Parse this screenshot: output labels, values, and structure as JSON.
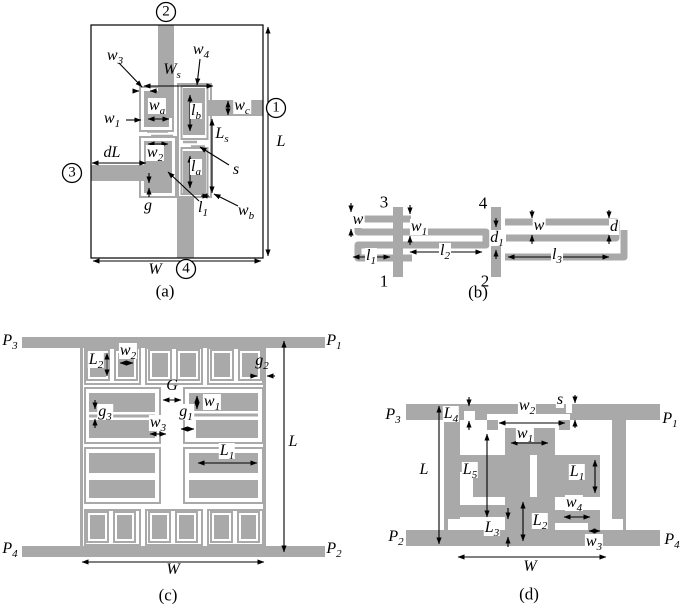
{
  "colors": {
    "metal": "#a9a9a9",
    "line": "#000000",
    "background": "#ffffff"
  },
  "figures": {
    "a": {
      "caption": "(a)",
      "ports": {
        "p1": "1",
        "p2": "2",
        "p3": "3",
        "p4": "4"
      },
      "labels": {
        "w3": {
          "b": "w",
          "s": "3"
        },
        "w4": {
          "b": "w",
          "s": "4"
        },
        "Ws": {
          "b": "W",
          "s": "s"
        },
        "wc": {
          "b": "w",
          "s": "c"
        },
        "wa": {
          "b": "w",
          "s": "a"
        },
        "w1": {
          "b": "w",
          "s": "1"
        },
        "lb": {
          "b": "l",
          "s": "b"
        },
        "Ls": {
          "b": "L",
          "s": "s"
        },
        "dL": {
          "b": "dL"
        },
        "w2": {
          "b": "w",
          "s": "2"
        },
        "s": {
          "b": "s"
        },
        "la": {
          "b": "l",
          "s": "a"
        },
        "g": {
          "b": "g"
        },
        "l1": {
          "b": "l",
          "s": "1"
        },
        "wb": {
          "b": "w",
          "s": "b"
        },
        "L": {
          "b": "L"
        },
        "W": {
          "b": "W"
        }
      }
    },
    "b": {
      "caption": "(b)",
      "ports": {
        "n1": "1",
        "n2": "2",
        "n3": "3",
        "n4": "4"
      },
      "labels": {
        "w_left": {
          "b": "w"
        },
        "w1": {
          "b": "w",
          "s": "1"
        },
        "l1": {
          "b": "l",
          "s": "1"
        },
        "l2": {
          "b": "l",
          "s": "2"
        },
        "l3": {
          "b": "l",
          "s": "3"
        },
        "d1": {
          "b": "d",
          "s": "1"
        },
        "w_right": {
          "b": "w"
        },
        "d": {
          "b": "d"
        }
      }
    },
    "c": {
      "caption": "(c)",
      "ports": {
        "P1": {
          "b": "P",
          "s": "1"
        },
        "P2": {
          "b": "P",
          "s": "2"
        },
        "P3": {
          "b": "P",
          "s": "3"
        },
        "P4": {
          "b": "P",
          "s": "4"
        }
      },
      "labels": {
        "L2": {
          "b": "L",
          "s": "2"
        },
        "w2": {
          "b": "w",
          "s": "2"
        },
        "g2": {
          "b": "g",
          "s": "2"
        },
        "G": {
          "b": "G"
        },
        "g3": {
          "b": "g",
          "s": "3"
        },
        "w1": {
          "b": "w",
          "s": "1"
        },
        "g1": {
          "b": "g",
          "s": "1"
        },
        "w3": {
          "b": "w",
          "s": "3"
        },
        "L1": {
          "b": "L",
          "s": "1"
        },
        "L": {
          "b": "L"
        },
        "W": {
          "b": "W"
        }
      }
    },
    "d": {
      "caption": "(d)",
      "ports": {
        "P1": {
          "b": "P",
          "s": "1"
        },
        "P2": {
          "b": "P",
          "s": "2"
        },
        "P3": {
          "b": "P",
          "s": "3"
        },
        "P4": {
          "b": "P",
          "s": "4"
        }
      },
      "labels": {
        "L4": {
          "b": "L",
          "s": "4"
        },
        "w2": {
          "b": "w",
          "s": "2"
        },
        "s": {
          "b": "s"
        },
        "w1": {
          "b": "w",
          "s": "1"
        },
        "L": {
          "b": "L"
        },
        "L5": {
          "b": "L",
          "s": "5"
        },
        "L1": {
          "b": "L",
          "s": "1"
        },
        "w4": {
          "b": "w",
          "s": "4"
        },
        "L3": {
          "b": "L",
          "s": "3"
        },
        "L2": {
          "b": "L",
          "s": "2"
        },
        "w3": {
          "b": "w",
          "s": "3"
        },
        "W": {
          "b": "W"
        }
      }
    }
  }
}
